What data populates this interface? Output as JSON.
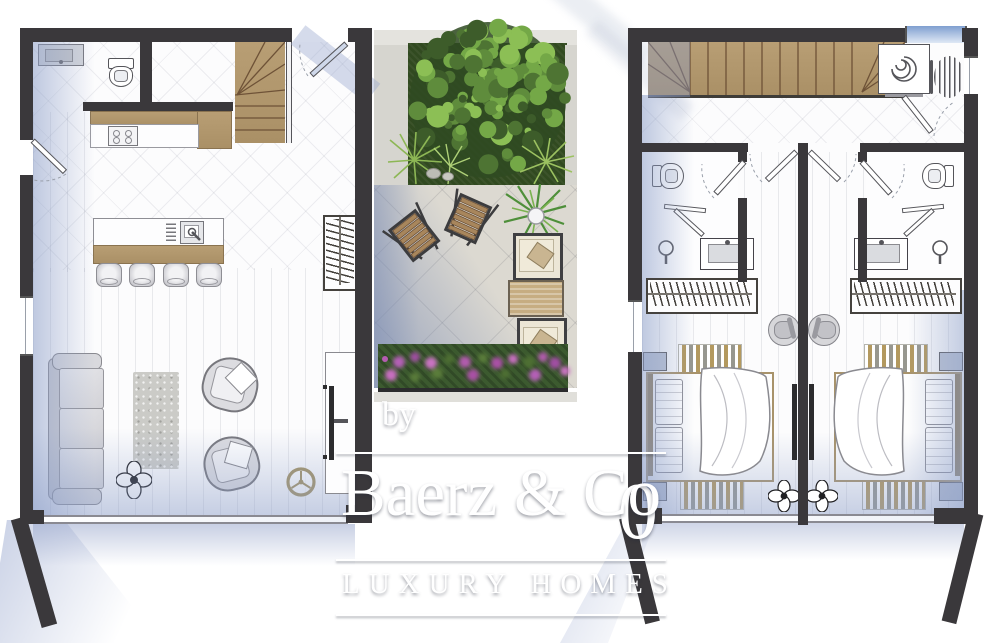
{
  "watermark": {
    "prefix": "by",
    "brand": "Baerz & Co",
    "tagline": "LUXURY HOMES",
    "numeral": "0"
  },
  "palette": {
    "wall": "#3a383b",
    "wood": "#b59b71",
    "wood_dark": "#6e5237",
    "floor": "#fcfcfd",
    "shadow": "#9db0d2",
    "garden": "#314a20",
    "patio": "#dcd9d1",
    "gold": "#a39263",
    "flower": "#b55cb1",
    "cushion": "#ece6d6",
    "wicker": "#c6ad82",
    "glass": "#cfd8ea"
  },
  "tree_colors": [
    "#3d5c2a",
    "#4e7433",
    "#5f8c3c",
    "#74a847",
    "#8cbf55",
    "#2f4a22"
  ],
  "ground_floor": {
    "name": "ground-floor-plan",
    "furniture": [
      "bathroom-sink",
      "toilet",
      "storage-room",
      "winder-staircase",
      "entry-glass-door",
      "kitchen-counter",
      "stove",
      "kitchen-island",
      "island-sink",
      "bar-stool",
      "bar-stool",
      "bar-stool",
      "bar-stool",
      "coat-wardrobe",
      "side-door",
      "sofa",
      "rug",
      "armchair",
      "armchair",
      "potted-plant",
      "ceiling-fan",
      "tv-cabinet",
      "tv",
      "sliding-glass-wall"
    ]
  },
  "courtyard": {
    "name": "courtyard",
    "furniture": [
      "lawn",
      "garden-tree",
      "ornamental-grass",
      "rocks",
      "folding-chair",
      "folding-chair",
      "potted-palm",
      "lounge-chair",
      "wicker-table",
      "lounge-chair",
      "flower-bed",
      "patio-tiles"
    ]
  },
  "upper_floor": {
    "name": "upper-floor-plan",
    "furniture": [
      "staircase",
      "washing-machine",
      "drying-rack",
      "landing-door",
      "suite-door",
      "suite-door",
      "toilet",
      "toilet",
      "shower",
      "shower",
      "shower-head",
      "shower-head",
      "washbasin",
      "washbasin",
      "bathroom-door",
      "bathroom-door",
      "wardrobe",
      "wardrobe",
      "double-bed",
      "double-bed",
      "bed-runner",
      "bed-runner",
      "bed-runner",
      "bed-runner",
      "nightstand",
      "nightstand",
      "desk-chair",
      "desk-chair",
      "wall-tv",
      "wall-tv",
      "potted-plant",
      "potted-plant",
      "sliding-glass-wall",
      "sliding-glass-wall",
      "window"
    ]
  }
}
